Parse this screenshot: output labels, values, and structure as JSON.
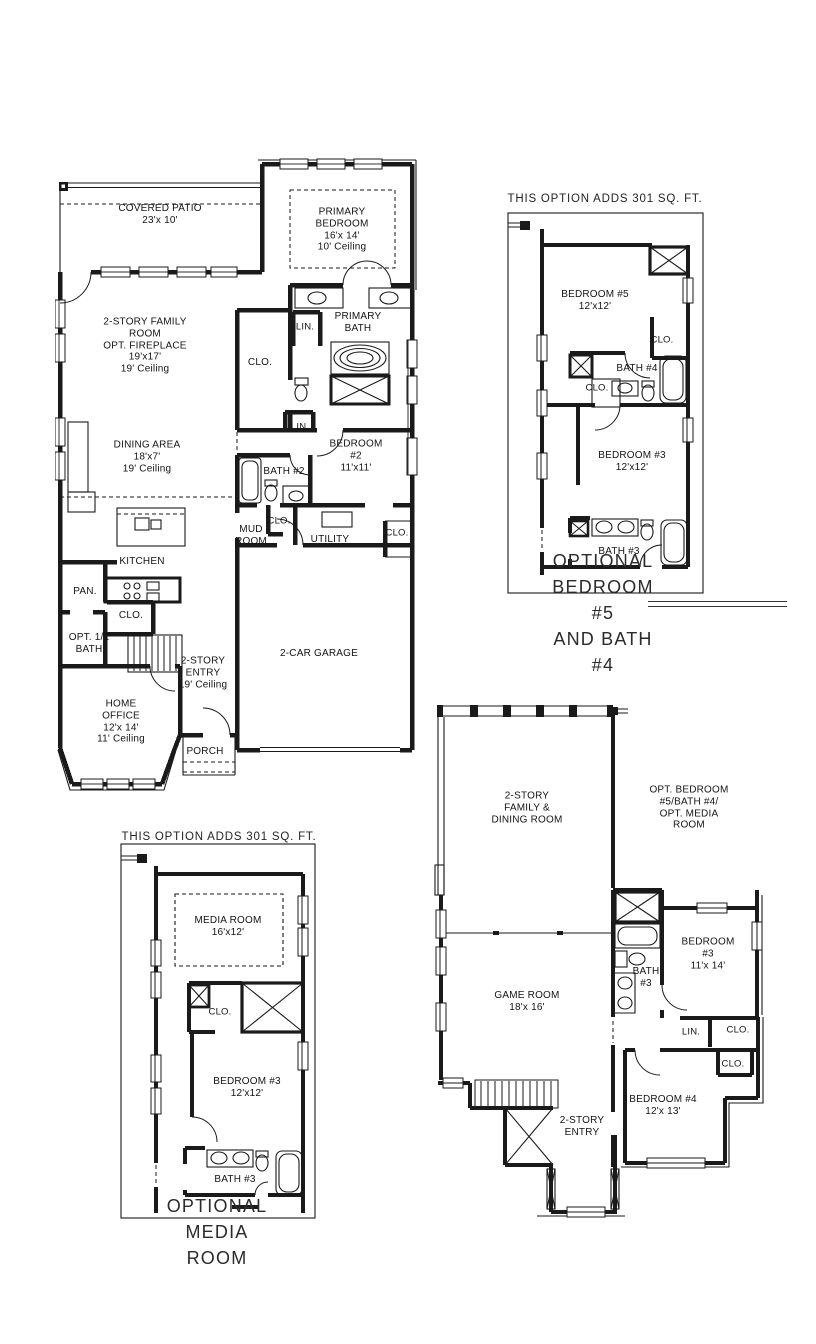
{
  "first_floor": {
    "covered_patio": "COVERED PATIO\n23'x 10'",
    "primary_bedroom": "PRIMARY\nBEDROOM\n16'x 14'\n10' Ceiling",
    "family_room": "2-STORY FAMILY\nROOM\nOPT. FIREPLACE\n19'x17'\n19' Ceiling",
    "linen1": "LIN.",
    "primary_bath": "PRIMARY\nBATH",
    "primary_closet": "CLO.",
    "linen2": "LIN.",
    "dining_area": "DINING AREA\n18'x7'\n19' Ceiling",
    "bedroom2": "BEDROOM #2\n11'x11'",
    "bath2": "BATH #2",
    "mud_closet": "CLO.",
    "mud_room": "MUD\nROOM",
    "utility": "UTILITY",
    "garage_closet": "CLO.",
    "kitchen": "KITCHEN",
    "pantry": "PAN.",
    "stair_closet": "CLO.",
    "opt_half_bath": "OPT. 1/2\nBATH",
    "entry": "2-STORY\nENTRY\n19' Ceiling",
    "garage": "2-CAR GARAGE",
    "home_office": "HOME\nOFFICE\n12'x 14'\n11' Ceiling",
    "porch": "PORCH"
  },
  "option_bedroom5": {
    "header": "THIS OPTION ADDS 301 SQ. FT.",
    "bedroom5": "BEDROOM #5\n12'x12'",
    "closet1": "CLO.",
    "bath4": "BATH #4",
    "closet2": "CLO.",
    "bedroom3": "BEDROOM #3\n12'x12'",
    "bath3": "BATH #3",
    "caption": "OPTIONAL BEDROOM #5\nAND BATH #4"
  },
  "option_media": {
    "header": "THIS OPTION ADDS 301 SQ. FT.",
    "media_room": "MEDIA ROOM\n16'x12'",
    "closet": "CLO.",
    "bedroom3": "BEDROOM #3\n12'x12'",
    "bath3": "BATH #3",
    "caption": "OPTIONAL MEDIA ROOM"
  },
  "second_floor": {
    "family_dining": "2-STORY\nFAMILY &\nDINING ROOM",
    "opt_note": "OPT. BEDROOM\n#5/BATH #4/\nOPT. MEDIA ROOM",
    "game_room": "GAME ROOM\n18'x 16'",
    "bath3": "BATH\n#3",
    "bedroom3": "BEDROOM #3\n11'x 14'",
    "linen": "LIN.",
    "closet1": "CLO.",
    "closet2": "CLO.",
    "bedroom4": "BEDROOM #4\n12'x 13'",
    "entry": "2-STORY\nENTRY"
  }
}
